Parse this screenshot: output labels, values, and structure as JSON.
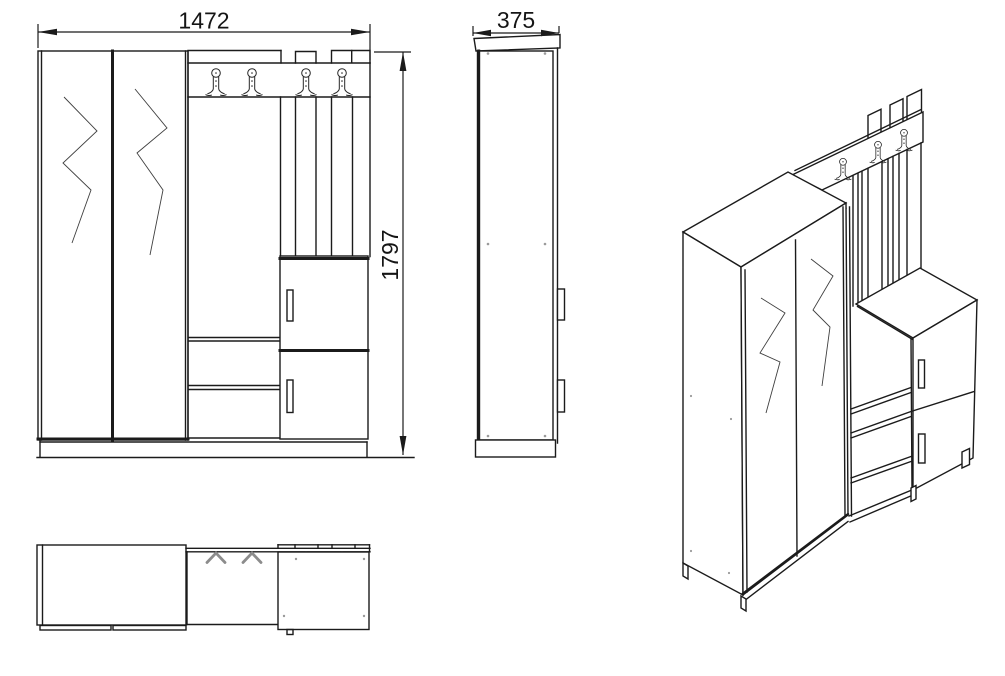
{
  "drawing": {
    "type": "furniture technical drawing",
    "subject": "hallway wardrobe with coat rack panel, open shelves and shoe cabinet",
    "dimensions": {
      "width": "1472",
      "depth": "375",
      "height": "1797"
    },
    "views": {
      "front": "front elevation",
      "side": "side elevation",
      "plan": "top plan view",
      "iso": "3d isometric view"
    },
    "features": {
      "coat_hooks_front_view": 4,
      "coat_hooks_plan_view": 4,
      "wardrobe_doors": 2,
      "cabinet_doors": 2,
      "open_shelves": 2,
      "back_slats": 3
    }
  },
  "colors": {
    "background": "#ffffff",
    "line": "#1b1b1b",
    "thin_line": "#3f3f3f",
    "hook_gray": "#8c8c8c"
  }
}
